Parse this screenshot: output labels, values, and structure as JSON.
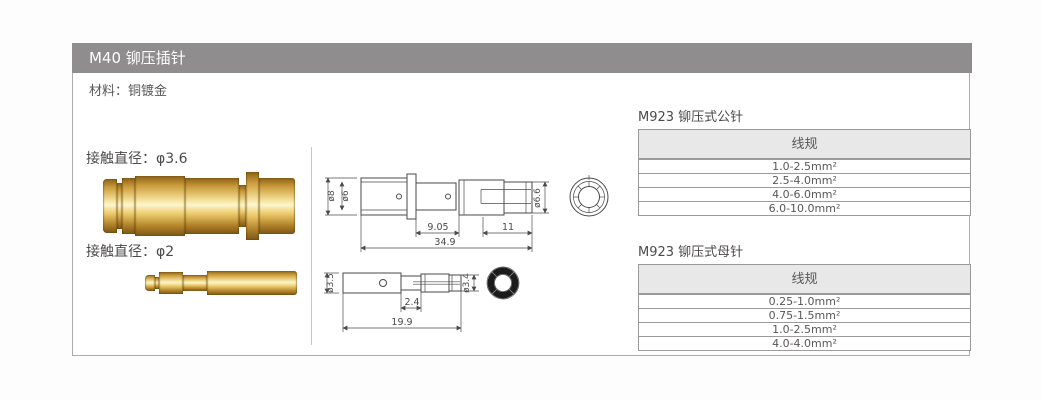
{
  "header": {
    "title": "M40 铆压插针"
  },
  "material": {
    "label": "材料：铜镀金"
  },
  "photo_section": {
    "pin1_label": "接触直径：φ3.6",
    "pin2_label": "接触直径：φ2"
  },
  "drawings": {
    "male": {
      "dia_outer": "ø8",
      "dia_inner": "ø6",
      "len_neck": "9.05",
      "len_tip": "11",
      "len_total": "34.9",
      "dia_tip": "ø6.6"
    },
    "female": {
      "dia_body": "ø3.5",
      "len_step": "2.4",
      "len_total": "19.9",
      "dia_tip": "ø3.4"
    }
  },
  "tables": [
    {
      "title": "M923 铆压式公针",
      "header": "线规",
      "rows": [
        "1.0-2.5mm²",
        "2.5-4.0mm²",
        "4.0-6.0mm²",
        "6.0-10.0mm²"
      ]
    },
    {
      "title": "M923 铆压式母针",
      "header": "线规",
      "rows": [
        "0.25-1.0mm²",
        "0.75-1.5mm²",
        "1.0-2.5mm²",
        "4.0-4.0mm²"
      ]
    }
  ],
  "colors": {
    "header_bar": "#908d8e",
    "table_header_bg": "#e9e8e8",
    "border": "#9c9a9a",
    "text": "#595757",
    "drawing_line": "#4a4a4a",
    "gold_light": "#f7e7a8",
    "gold_dark": "#8a5f18"
  }
}
